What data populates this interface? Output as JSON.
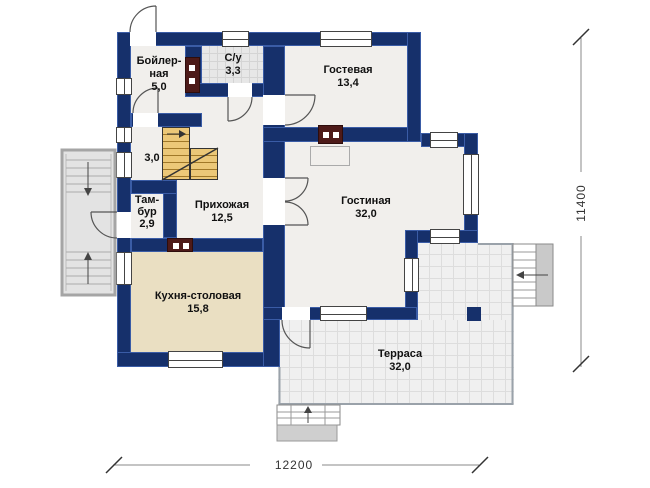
{
  "rooms": {
    "boiler": {
      "name_line1": "Бойлер-",
      "name_line2": "ная",
      "area": "5,0"
    },
    "wc": {
      "name": "С/у",
      "area": "3,3"
    },
    "guest": {
      "name": "Гостевая",
      "area": "13,4"
    },
    "stair_landing": {
      "area": "3,0"
    },
    "tambour": {
      "name_line1": "Там-",
      "name_line2": "бур",
      "area": "2,9"
    },
    "hallway": {
      "name": "Прихожая",
      "area": "12,5"
    },
    "living": {
      "name": "Гостиная",
      "area": "32,0"
    },
    "kitchen": {
      "name": "Кухня-столовая",
      "area": "15,8"
    },
    "terrace": {
      "name": "Терраса",
      "area": "32,0"
    }
  },
  "dimensions": {
    "width_mm": "12200",
    "depth_mm": "11400"
  },
  "colors": {
    "wall": "#16306b",
    "wallEdge": "#3a5ca6",
    "floor": "#f1efec",
    "bath": "#e7e7e7",
    "kitchen": "#eadfc2",
    "terrace": "#f0f0f0",
    "stairs": "#ecc878",
    "chimney": "#4d1a18",
    "porch": "#e3e3e3",
    "line": "#555555",
    "dim": "#888888",
    "text": "#111111"
  }
}
